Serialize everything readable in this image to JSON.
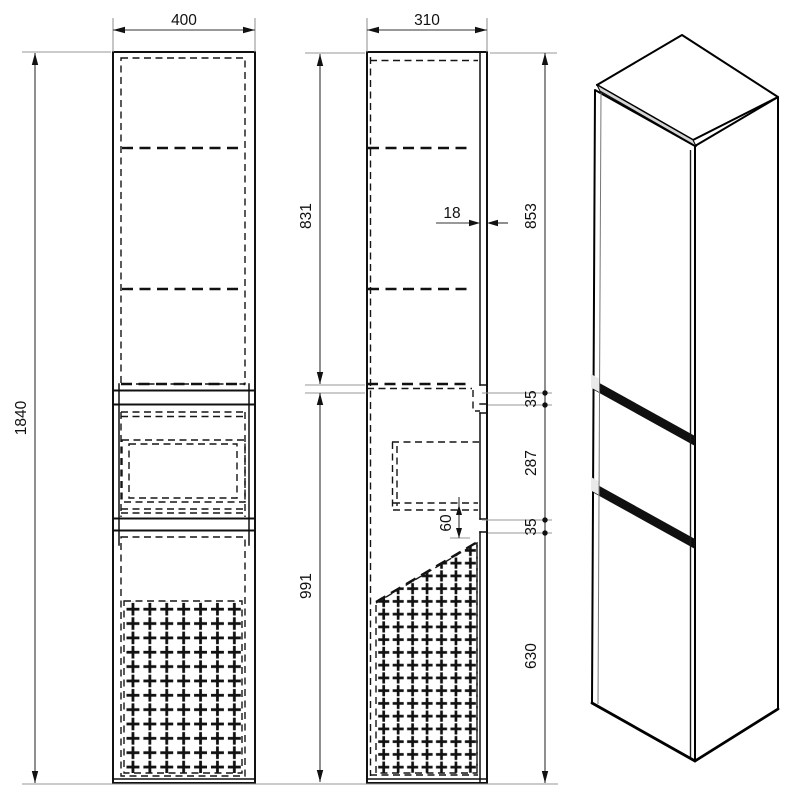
{
  "drawing": {
    "subject": "tall-cabinet-technical-drawing",
    "views": [
      "front-view",
      "side-view",
      "isometric-view"
    ]
  },
  "dims": {
    "front_width": "400",
    "side_depth": "310",
    "total_height": "1840",
    "upper_door_height": "831",
    "lower_section_height": "991",
    "door_thickness": "18",
    "chain_top": "853",
    "chain_gap1": "35",
    "chain_drawer": "287",
    "chain_gap2": "35",
    "chain_bottom": "630",
    "drawer_clearance": "60"
  },
  "colors": {
    "line": "#111111",
    "extension_line": "#979797",
    "iso_top_face": "#a9a9a9",
    "iso_front_face": "#484848",
    "iso_side_face": "#8b8b8b",
    "iso_edge_strip": "#d4d4d4",
    "iso_groove": "#101010",
    "background": "#ffffff"
  }
}
